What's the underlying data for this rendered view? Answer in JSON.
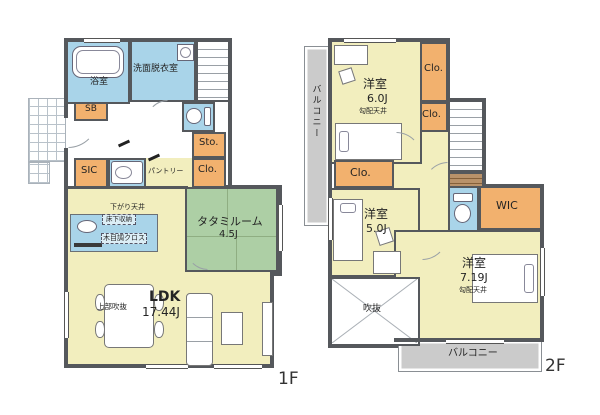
{
  "title": "2-story house floor plan",
  "colors": {
    "wall": "#55585c",
    "yellow": "#f2eebe",
    "blue": "#a9d4e9",
    "orange": "#f2b16e",
    "green": "#adcfa5",
    "gray": "#cbcbcb",
    "white": "#ffffff",
    "line": "#8a8f94"
  },
  "floors": [
    {
      "id": "1f",
      "caption": "1F",
      "elements": [
        {
          "k": "fill",
          "n": "entrance-hall",
          "x": 66,
          "y": 100,
          "w": 118,
          "h": 88,
          "f": "white"
        },
        {
          "k": "fill",
          "n": "ldk-dining-area",
          "x": 66,
          "y": 188,
          "w": 119,
          "h": 180,
          "f": "yellow"
        },
        {
          "k": "fill",
          "n": "ldk-living-area",
          "x": 185,
          "y": 272,
          "w": 88,
          "h": 94,
          "f": "yellow"
        },
        {
          "k": "fill",
          "n": "pantry-area",
          "x": 146,
          "y": 158,
          "w": 46,
          "h": 30,
          "f": "yellow"
        },
        {
          "k": "hatch",
          "n": "entrance-porch",
          "x": 28,
          "y": 98,
          "w": 38,
          "h": 64
        },
        {
          "k": "hatch",
          "n": "porch-step",
          "x": 28,
          "y": 162,
          "w": 22,
          "h": 22
        },
        {
          "k": "room",
          "n": "bathroom",
          "x": 66,
          "y": 40,
          "w": 64,
          "h": 64,
          "f": "blue"
        },
        {
          "k": "room",
          "n": "washroom",
          "x": 130,
          "y": 40,
          "w": 66,
          "h": 62,
          "f": "blue"
        },
        {
          "k": "stairs",
          "n": "stairs-1f",
          "x": 196,
          "y": 40,
          "w": 34,
          "h": 62
        },
        {
          "k": "room",
          "n": "toilet-1f",
          "x": 182,
          "y": 102,
          "w": 33,
          "h": 30,
          "f": "blue"
        },
        {
          "k": "room",
          "n": "shoe-box",
          "x": 74,
          "y": 102,
          "w": 34,
          "h": 19,
          "f": "orange"
        },
        {
          "k": "room",
          "n": "storage-1f",
          "x": 192,
          "y": 132,
          "w": 34,
          "h": 26,
          "f": "orange"
        },
        {
          "k": "room",
          "n": "closet-1f",
          "x": 192,
          "y": 158,
          "w": 34,
          "h": 30,
          "f": "orange"
        },
        {
          "k": "room",
          "n": "shoes-in-closet",
          "x": 74,
          "y": 158,
          "w": 34,
          "h": 30,
          "f": "orange"
        },
        {
          "k": "room",
          "n": "powder-room",
          "x": 108,
          "y": 158,
          "w": 38,
          "h": 30,
          "f": "blue"
        },
        {
          "k": "tatami",
          "n": "tatami-room",
          "x": 185,
          "y": 187,
          "w": 93,
          "h": 85,
          "f": "green"
        },
        {
          "k": "roomthin",
          "n": "kitchen-counter",
          "x": 70,
          "y": 214,
          "w": 88,
          "h": 38,
          "f": "blue"
        },
        {
          "k": "wall",
          "x": 64,
          "y": 38,
          "w": 168,
          "h": 4
        },
        {
          "k": "wall",
          "x": 228,
          "y": 38,
          "w": 4,
          "h": 150
        },
        {
          "k": "wall",
          "x": 226,
          "y": 185,
          "w": 56,
          "h": 4
        },
        {
          "k": "wall",
          "x": 278,
          "y": 185,
          "w": 4,
          "h": 90
        },
        {
          "k": "wall",
          "x": 270,
          "y": 272,
          "w": 12,
          "h": 4
        },
        {
          "k": "wall",
          "x": 270,
          "y": 272,
          "w": 4,
          "h": 94
        },
        {
          "k": "wall",
          "x": 64,
          "y": 364,
          "w": 210,
          "h": 4
        },
        {
          "k": "wall",
          "x": 64,
          "y": 38,
          "w": 4,
          "h": 80
        },
        {
          "k": "wall",
          "x": 64,
          "y": 148,
          "w": 4,
          "h": 220
        },
        {
          "k": "wall",
          "x": 64,
          "y": 186,
          "w": 124,
          "h": 3
        },
        {
          "k": "winH",
          "x": 84,
          "y": 38,
          "w": 36,
          "h": 5
        },
        {
          "k": "winV",
          "x": 278,
          "y": 205,
          "w": 5,
          "h": 46
        },
        {
          "k": "winH",
          "x": 146,
          "y": 364,
          "w": 42,
          "h": 5
        },
        {
          "k": "winH",
          "x": 214,
          "y": 364,
          "w": 48,
          "h": 5
        },
        {
          "k": "winV",
          "x": 64,
          "y": 292,
          "w": 5,
          "h": 46
        },
        {
          "k": "tub",
          "n": "bathtub",
          "x": 72,
          "y": 46,
          "w": 52,
          "h": 32
        },
        {
          "k": "washer",
          "n": "washing-machine",
          "x": 177,
          "y": 44,
          "w": 17,
          "h": 17
        },
        {
          "k": "toiletH",
          "n": "toilet-1f-fixture",
          "x": 186,
          "y": 107,
          "w": 25,
          "h": 19
        },
        {
          "k": "vanity",
          "n": "powder-fixture",
          "x": 111,
          "y": 161,
          "w": 32,
          "h": 23
        },
        {
          "k": "sink",
          "n": "kitchen-sink",
          "x": 77,
          "y": 220,
          "w": 20,
          "h": 13
        },
        {
          "k": "bar",
          "n": "stove",
          "x": 74,
          "y": 243,
          "w": 28,
          "h": 4
        },
        {
          "k": "table",
          "n": "dining-table",
          "x": 104,
          "y": 284,
          "w": 50,
          "h": 64
        },
        {
          "k": "chair",
          "n": "dining-chair",
          "x": 95,
          "y": 294,
          "w": 10,
          "h": 17
        },
        {
          "k": "chair",
          "n": "dining-chair",
          "x": 95,
          "y": 321,
          "w": 10,
          "h": 17
        },
        {
          "k": "chair",
          "n": "dining-chair",
          "x": 154,
          "y": 294,
          "w": 10,
          "h": 17
        },
        {
          "k": "chair",
          "n": "dining-chair",
          "x": 154,
          "y": 321,
          "w": 10,
          "h": 17
        },
        {
          "k": "sofa",
          "n": "sofa",
          "x": 186,
          "y": 293,
          "w": 27,
          "h": 73
        },
        {
          "k": "box",
          "n": "coffee-table",
          "x": 221,
          "y": 312,
          "w": 22,
          "h": 33
        },
        {
          "k": "box",
          "n": "tv-board",
          "x": 262,
          "y": 302,
          "w": 11,
          "h": 54
        },
        {
          "k": "arc",
          "x": 68,
          "y": 118,
          "w": 30,
          "h": 30,
          "q": "br"
        },
        {
          "k": "arc",
          "x": 146,
          "y": 100,
          "w": 22,
          "h": 22,
          "q": "tl"
        },
        {
          "k": "arc",
          "x": 186,
          "y": 248,
          "w": 22,
          "h": 22,
          "q": "bl"
        },
        {
          "k": "mark",
          "x": 118,
          "y": 142,
          "w": 12,
          "h": 3
        },
        {
          "k": "mark",
          "x": 148,
          "y": 156,
          "w": 12,
          "h": 3
        },
        {
          "k": "label",
          "t": "浴室",
          "x": 90,
          "y": 78,
          "s": 9
        },
        {
          "k": "label",
          "t": "洗面脱衣室",
          "x": 133,
          "y": 65,
          "s": 9
        },
        {
          "k": "label",
          "t": "SB",
          "x": 85,
          "y": 105,
          "s": 9
        },
        {
          "k": "label",
          "t": "Sto.",
          "x": 199,
          "y": 138,
          "s": 10
        },
        {
          "k": "label",
          "t": "Clo.",
          "x": 198,
          "y": 165,
          "s": 10
        },
        {
          "k": "label",
          "t": "SIC",
          "x": 81,
          "y": 166,
          "s": 10
        },
        {
          "k": "label",
          "t": "パントリー",
          "x": 148,
          "y": 168,
          "s": 7
        },
        {
          "k": "label",
          "t": "下がり天井",
          "x": 110,
          "y": 204,
          "s": 7
        },
        {
          "k": "label",
          "t": "床下収納",
          "x": 102,
          "y": 214,
          "s": 6.5,
          "wrap": true,
          "w": 30,
          "boxed": true
        },
        {
          "k": "label",
          "t": "木目調クロス",
          "x": 101,
          "y": 233,
          "s": 7,
          "boxed": true
        },
        {
          "k": "label",
          "t": "タタミルーム",
          "x": 197,
          "y": 216,
          "s": 11
        },
        {
          "k": "label",
          "t": "4.5J",
          "x": 219,
          "y": 230,
          "s": 10
        },
        {
          "k": "label",
          "t": "LDK",
          "x": 149,
          "y": 290,
          "s": 14,
          "bold": true
        },
        {
          "k": "label",
          "t": "17.44J",
          "x": 142,
          "y": 306,
          "s": 12
        },
        {
          "k": "label",
          "t": "上部吹抜",
          "x": 97,
          "y": 303,
          "s": 7.5
        }
      ]
    },
    {
      "id": "2f",
      "caption": "2F",
      "elements": [
        {
          "k": "fill",
          "n": "hall-2f",
          "x": 394,
          "y": 126,
          "w": 56,
          "h": 106,
          "f": "yellow"
        },
        {
          "k": "balc",
          "n": "balcony-side",
          "x": 304,
          "y": 46,
          "w": 26,
          "h": 180,
          "f": "gray"
        },
        {
          "k": "balc",
          "n": "balcony-rear",
          "x": 398,
          "y": 340,
          "w": 144,
          "h": 32,
          "f": "gray"
        },
        {
          "k": "room",
          "n": "bedroom-6",
          "x": 330,
          "y": 40,
          "w": 92,
          "h": 124,
          "f": "yellow"
        },
        {
          "k": "room",
          "n": "closet-2f-a",
          "x": 420,
          "y": 42,
          "w": 28,
          "h": 60,
          "f": "orange"
        },
        {
          "k": "room",
          "n": "closet-2f-b",
          "x": 420,
          "y": 102,
          "w": 28,
          "h": 30,
          "f": "orange"
        },
        {
          "k": "stairs",
          "n": "stairs-2f",
          "x": 448,
          "y": 100,
          "w": 36,
          "h": 72
        },
        {
          "k": "landing",
          "n": "stairs-landing",
          "x": 448,
          "y": 172,
          "w": 36,
          "h": 18
        },
        {
          "k": "room",
          "n": "closet-2f-c",
          "x": 334,
          "y": 160,
          "w": 60,
          "h": 28,
          "f": "orange"
        },
        {
          "k": "room",
          "n": "bedroom-5",
          "x": 330,
          "y": 188,
          "w": 90,
          "h": 89,
          "f": "yellow"
        },
        {
          "k": "room",
          "n": "toilet-2f",
          "x": 448,
          "y": 186,
          "w": 31,
          "h": 46,
          "f": "blue"
        },
        {
          "k": "room",
          "n": "wic",
          "x": 479,
          "y": 186,
          "w": 63,
          "h": 44,
          "f": "orange"
        },
        {
          "k": "room",
          "n": "bedroom-7",
          "x": 394,
          "y": 230,
          "w": 148,
          "h": 110,
          "f": "yellow"
        },
        {
          "k": "void",
          "n": "open-void",
          "x": 330,
          "y": 277,
          "w": 90,
          "h": 69
        },
        {
          "k": "wall",
          "x": 328,
          "y": 38,
          "w": 122,
          "h": 4
        },
        {
          "k": "wall",
          "x": 446,
          "y": 38,
          "w": 4,
          "h": 64
        },
        {
          "k": "wall",
          "x": 446,
          "y": 98,
          "w": 40,
          "h": 4
        },
        {
          "k": "wall",
          "x": 482,
          "y": 98,
          "w": 4,
          "h": 90
        },
        {
          "k": "wall",
          "x": 482,
          "y": 184,
          "w": 62,
          "h": 4
        },
        {
          "k": "wall",
          "x": 540,
          "y": 184,
          "w": 4,
          "h": 158
        },
        {
          "k": "wall",
          "x": 394,
          "y": 338,
          "w": 150,
          "h": 4
        },
        {
          "k": "wall",
          "x": 328,
          "y": 38,
          "w": 4,
          "h": 310
        },
        {
          "k": "wall",
          "x": 328,
          "y": 344,
          "w": 70,
          "h": 4
        },
        {
          "k": "winH",
          "x": 344,
          "y": 38,
          "w": 52,
          "h": 5
        },
        {
          "k": "winV",
          "x": 540,
          "y": 248,
          "w": 5,
          "h": 48
        },
        {
          "k": "winV",
          "x": 328,
          "y": 198,
          "w": 5,
          "h": 42
        },
        {
          "k": "winH",
          "x": 446,
          "y": 339,
          "w": 58,
          "h": 5
        },
        {
          "k": "box",
          "n": "desk-6",
          "x": 334,
          "y": 45,
          "w": 34,
          "h": 20
        },
        {
          "k": "chairS",
          "n": "chair-6",
          "x": 340,
          "y": 69,
          "w": 14,
          "h": 14
        },
        {
          "k": "bedH",
          "n": "bed-6",
          "x": 335,
          "y": 123,
          "w": 67,
          "h": 37,
          "p": "l"
        },
        {
          "k": "bedV",
          "n": "bed-5",
          "x": 333,
          "y": 199,
          "w": 30,
          "h": 62
        },
        {
          "k": "box",
          "n": "desk-5",
          "x": 373,
          "y": 251,
          "w": 28,
          "h": 23
        },
        {
          "k": "chairS",
          "n": "chair-5",
          "x": 377,
          "y": 229,
          "w": 15,
          "h": 15
        },
        {
          "k": "bedH",
          "n": "bed-7",
          "x": 472,
          "y": 254,
          "w": 66,
          "h": 49,
          "p": "r"
        },
        {
          "k": "toiletV",
          "n": "toilet-2f-fixture",
          "x": 453,
          "y": 193,
          "w": 20,
          "h": 30
        },
        {
          "k": "arc",
          "x": 396,
          "y": 132,
          "w": 26,
          "h": 26,
          "q": "tr"
        },
        {
          "k": "arc",
          "x": 422,
          "y": 234,
          "w": 26,
          "h": 26,
          "q": "br"
        },
        {
          "k": "arc",
          "x": 424,
          "y": 162,
          "w": 24,
          "h": 24,
          "q": "tl"
        },
        {
          "k": "label",
          "t": "バルコニー",
          "x": 310,
          "y": 84,
          "s": 9,
          "vert": true
        },
        {
          "k": "label",
          "t": "洋室",
          "x": 363,
          "y": 78,
          "s": 12
        },
        {
          "k": "label",
          "t": "6.0J",
          "x": 367,
          "y": 93,
          "s": 11
        },
        {
          "k": "label",
          "t": "勾配天井",
          "x": 359,
          "y": 108,
          "s": 7
        },
        {
          "k": "label",
          "t": "Clo.",
          "x": 424,
          "y": 64,
          "s": 10
        },
        {
          "k": "label",
          "t": "Clo.",
          "x": 422,
          "y": 110,
          "s": 10
        },
        {
          "k": "label",
          "t": "Clo.",
          "x": 350,
          "y": 167,
          "s": 11
        },
        {
          "k": "label",
          "t": "洋室",
          "x": 364,
          "y": 208,
          "s": 12
        },
        {
          "k": "label",
          "t": "5.0J",
          "x": 366,
          "y": 223,
          "s": 11
        },
        {
          "k": "label",
          "t": "WIC",
          "x": 496,
          "y": 200,
          "s": 11
        },
        {
          "k": "label",
          "t": "洋室",
          "x": 462,
          "y": 257,
          "s": 12
        },
        {
          "k": "label",
          "t": "7.19J",
          "x": 460,
          "y": 272,
          "s": 11
        },
        {
          "k": "label",
          "t": "勾配天井",
          "x": 459,
          "y": 287,
          "s": 7
        },
        {
          "k": "label",
          "t": "吹抜",
          "x": 363,
          "y": 305,
          "s": 9
        },
        {
          "k": "label",
          "t": "バルコニー",
          "x": 448,
          "y": 349,
          "s": 10
        }
      ]
    }
  ]
}
